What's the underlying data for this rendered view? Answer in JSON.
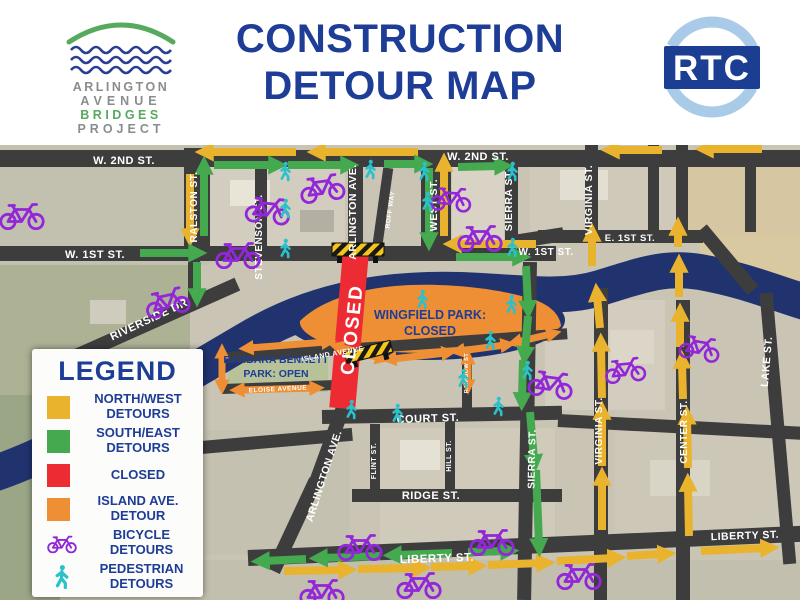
{
  "header": {
    "logo_lines": [
      "ARLINGTON",
      "AVENUE",
      "BRIDGES",
      "PROJECT"
    ],
    "title_line1": "CONSTRUCTION",
    "title_line2": "DETOUR MAP",
    "rtc_label": "RTC"
  },
  "legend": {
    "title": "LEGEND",
    "items": [
      {
        "label_line1": "NORTH/WEST",
        "label_line2": "DETOURS",
        "color": "#e9b32d"
      },
      {
        "label_line1": "SOUTH/EAST",
        "label_line2": "DETOURS",
        "color": "#44a94f"
      },
      {
        "label_line1": "CLOSED",
        "label_line2": "",
        "color": "#ed2b33"
      },
      {
        "label_line1": "ISLAND AVE.",
        "label_line2": "DETOUR",
        "color": "#ef8f35"
      },
      {
        "label_line1": "BICYCLE",
        "label_line2": "DETOURS",
        "color": "#9326d9"
      },
      {
        "label_line1": "PEDESTRIAN",
        "label_line2": "DETOURS",
        "color": "#29c1cb"
      }
    ]
  },
  "map": {
    "streets": {
      "w2nd_a": "W. 2ND ST.",
      "w2nd_b": "W. 2ND ST.",
      "w1st_a": "W. 1ST ST.",
      "w1st_b": "W. 1ST ST.",
      "e1st": "E. 1ST ST.",
      "ralston": "RALSTON ST.",
      "stevenson": "STEVENSON ST.",
      "arlington_n": "ARLINGTON AVE.",
      "roff": "ROFF WAY",
      "west": "WEST ST.",
      "sierra_n": "SIERRA ST.",
      "virginia_n": "VIRGINIA ST.",
      "lake": "LAKE ST.",
      "riverside": "RIVERSIDE DR.",
      "island": "ISLAND AVENUE",
      "eloise": "ELOISE AVENUE",
      "rainbow": "RAINBOW ST",
      "court": "COURT ST.",
      "ridge": "RIDGE ST.",
      "liberty_a": "LIBERTY ST.",
      "liberty_b": "LIBERTY ST.",
      "arlington_s": "ARLINGTON AVE.",
      "flint": "FLINT ST.",
      "hill": "HILL ST.",
      "sierra_s": "SIERRA ST.",
      "virginia_s": "VIRGINIA ST.",
      "center": "CENTER ST."
    },
    "annotations": {
      "closed": "CLOSED",
      "wingfield_line1": "WINGFIELD PARK:",
      "wingfield_line2": "CLOSED",
      "barbara_line1": "BARBARA BENNETT",
      "barbara_line2": "PARK: OPEN"
    },
    "colors": {
      "north_west_detour": "#e9b32d",
      "south_east_detour": "#44a94f",
      "closed": "#ed2b33",
      "island_detour": "#ef8f35",
      "bicycle": "#9326d9",
      "pedestrian": "#29c1cb",
      "river": "#20336f",
      "road": "#3d3d3d",
      "title_navy": "#1e3d96"
    }
  }
}
